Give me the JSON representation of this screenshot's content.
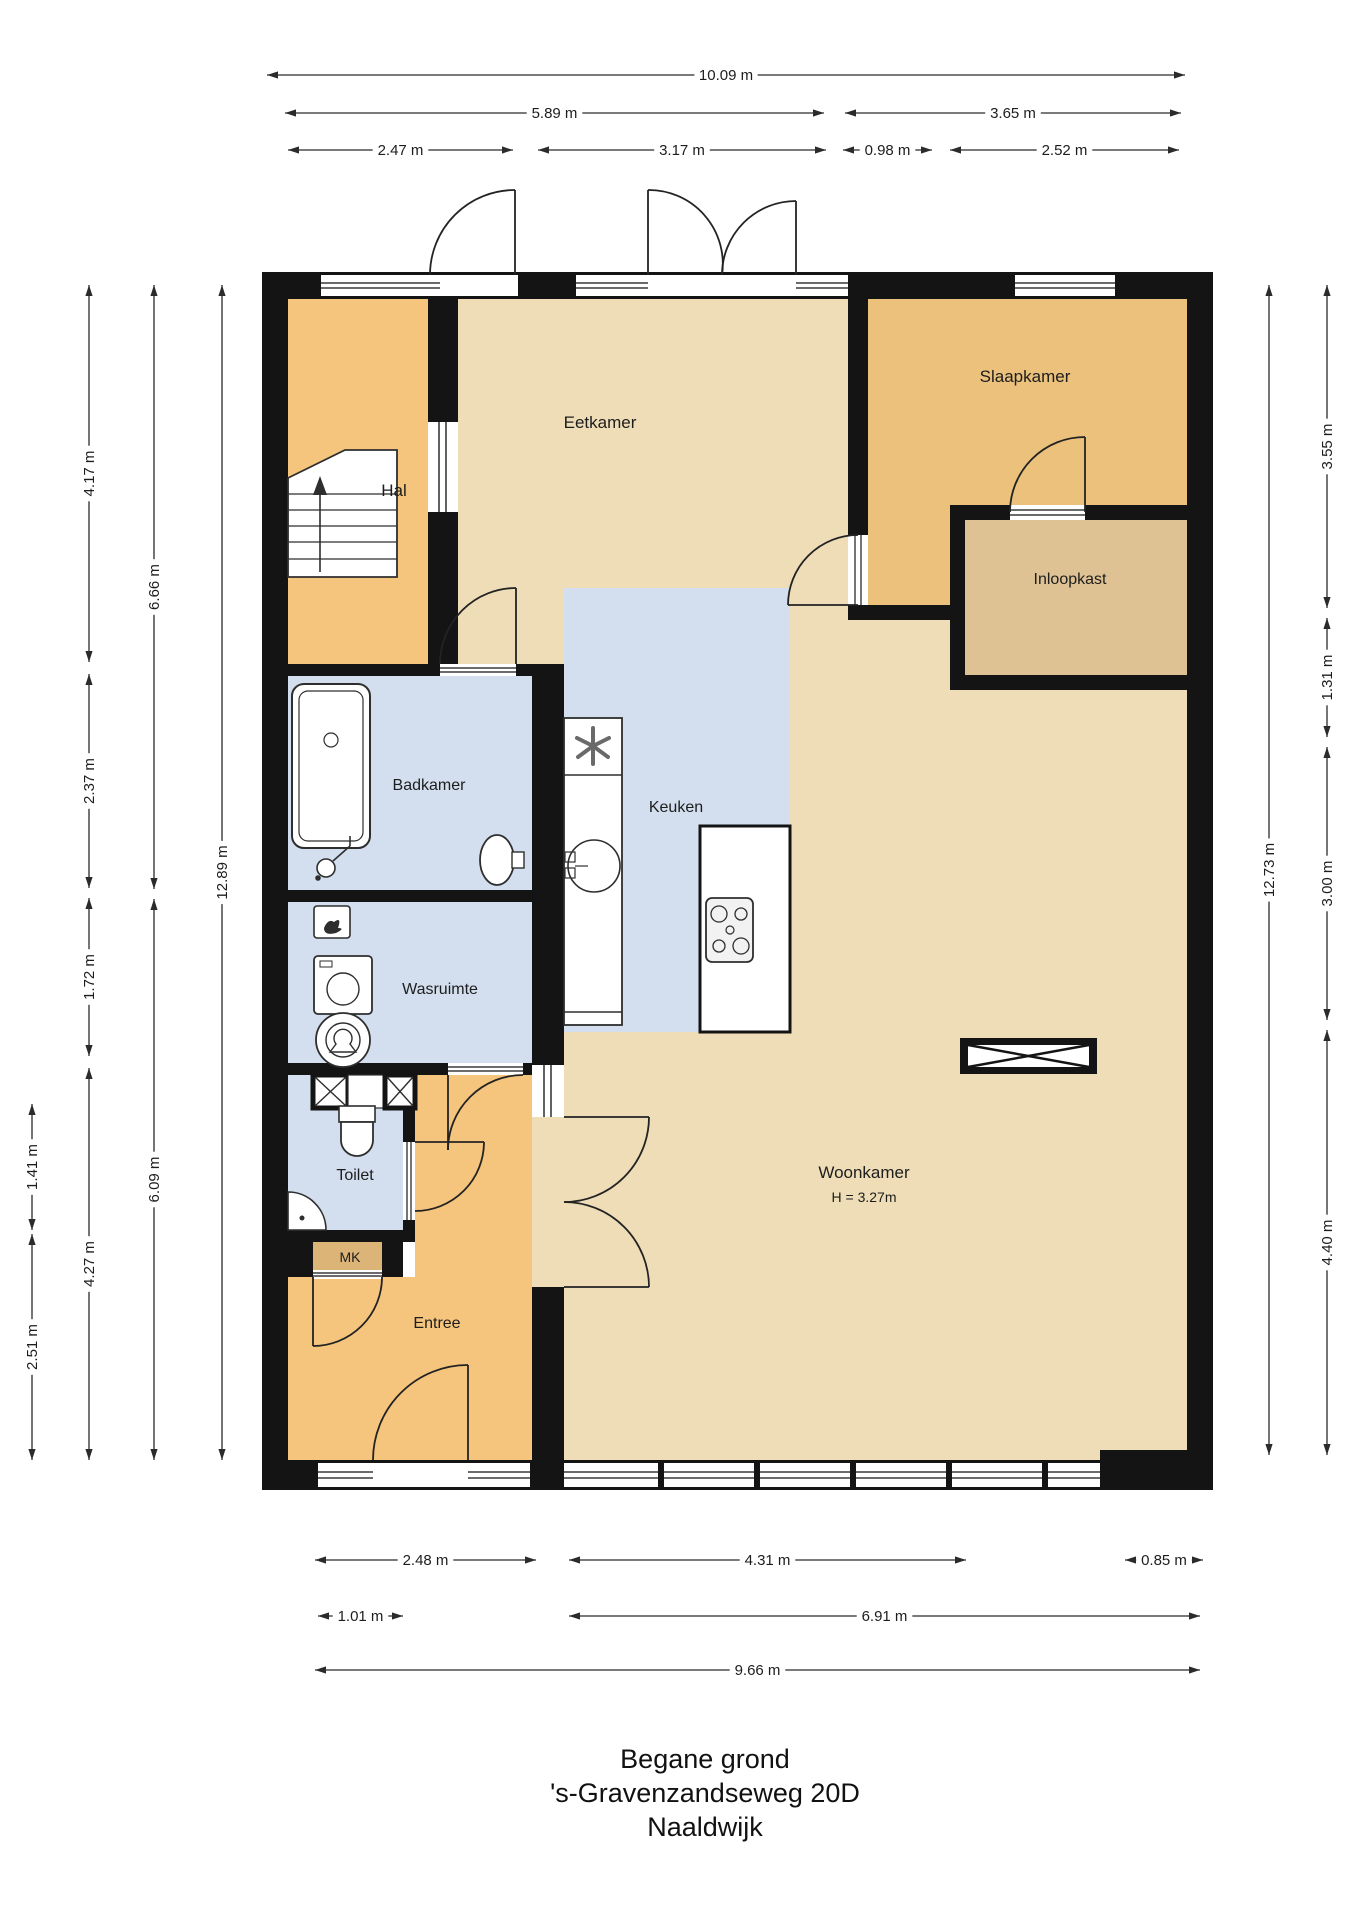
{
  "title": {
    "line1": "Begane grond",
    "line2": "'s-Gravenzandseweg 20D",
    "line3": "Naaldwijk"
  },
  "rooms": [
    {
      "name": "Hal",
      "x": 394,
      "y": 496,
      "size": 17
    },
    {
      "name": "Eetkamer",
      "x": 600,
      "y": 428,
      "size": 17
    },
    {
      "name": "Slaapkamer",
      "x": 1025,
      "y": 382,
      "size": 17
    },
    {
      "name": "Inloopkast",
      "x": 1070,
      "y": 584,
      "size": 16
    },
    {
      "name": "Badkamer",
      "x": 429,
      "y": 790,
      "size": 16
    },
    {
      "name": "Keuken",
      "x": 676,
      "y": 812,
      "size": 16
    },
    {
      "name": "Wasruimte",
      "x": 440,
      "y": 994,
      "size": 16
    },
    {
      "name": "Toilet",
      "x": 355,
      "y": 1180,
      "size": 16
    },
    {
      "name": "MK",
      "x": 350,
      "y": 1262,
      "size": 14
    },
    {
      "name": "Entree",
      "x": 437,
      "y": 1328,
      "size": 16
    },
    {
      "name": "Woonkamer",
      "x": 864,
      "y": 1178,
      "size": 17,
      "sub": "H = 3.27m",
      "subdy": 24,
      "subsize": 14
    }
  ],
  "dimensions": {
    "top": [
      {
        "label": "10.09 m",
        "x1": 267,
        "x2": 1185,
        "y": 75
      },
      {
        "label": "5.89 m",
        "x1": 285,
        "x2": 824,
        "y": 113
      },
      {
        "label": "3.65 m",
        "x1": 845,
        "x2": 1181,
        "y": 113
      },
      {
        "label": "2.47 m",
        "x1": 288,
        "x2": 513,
        "y": 150
      },
      {
        "label": "3.17 m",
        "x1": 538,
        "x2": 826,
        "y": 150
      },
      {
        "label": "0.98 m",
        "x1": 843,
        "x2": 932,
        "y": 150
      },
      {
        "label": "2.52 m",
        "x1": 950,
        "x2": 1179,
        "y": 150
      }
    ],
    "bottom": [
      {
        "label": "2.48 m",
        "x1": 315,
        "x2": 536,
        "y": 1560
      },
      {
        "label": "4.31 m",
        "x1": 569,
        "x2": 966,
        "y": 1560
      },
      {
        "label": "0.85 m",
        "x1": 1125,
        "x2": 1203,
        "y": 1560
      },
      {
        "label": "1.01 m",
        "x1": 318,
        "x2": 403,
        "y": 1616
      },
      {
        "label": "6.91 m",
        "x1": 569,
        "x2": 1200,
        "y": 1616
      },
      {
        "label": "9.66 m",
        "x1": 315,
        "x2": 1200,
        "y": 1670
      }
    ],
    "left": [
      {
        "label": "4.17 m",
        "x": 89,
        "y1": 285,
        "y2": 662
      },
      {
        "label": "2.37 m",
        "x": 89,
        "y1": 674,
        "y2": 888
      },
      {
        "label": "1.72 m",
        "x": 89,
        "y1": 898,
        "y2": 1056
      },
      {
        "label": "4.27 m",
        "x": 89,
        "y1": 1068,
        "y2": 1460
      },
      {
        "label": "6.66 m",
        "x": 154,
        "y1": 285,
        "y2": 889
      },
      {
        "label": "6.09 m",
        "x": 154,
        "y1": 899,
        "y2": 1460
      },
      {
        "label": "12.89 m",
        "x": 222,
        "y1": 285,
        "y2": 1460
      },
      {
        "label": "1.41 m",
        "x": 32,
        "y1": 1104,
        "y2": 1230
      },
      {
        "label": "2.51 m",
        "x": 32,
        "y1": 1234,
        "y2": 1460
      }
    ],
    "right": [
      {
        "label": "3.55 m",
        "x": 1327,
        "y1": 285,
        "y2": 608
      },
      {
        "label": "1.31 m",
        "x": 1327,
        "y1": 618,
        "y2": 737
      },
      {
        "label": "3.00 m",
        "x": 1327,
        "y1": 747,
        "y2": 1020
      },
      {
        "label": "4.40 m",
        "x": 1327,
        "y1": 1030,
        "y2": 1455
      },
      {
        "label": "12.73 m",
        "x": 1269,
        "y1": 285,
        "y2": 1455
      }
    ]
  },
  "colors": {
    "wall": "#141414",
    "hall_orange": "#f5c57d",
    "living_beige": "#eeddb6",
    "bedroom_tan": "#ebc17c",
    "closet_tan": "#dfc293",
    "mk_tan": "#dcb478",
    "wet_blue": "#d3dfee",
    "dim_line": "#2b2b2b",
    "fixture_stroke": "#2e2e2e"
  }
}
